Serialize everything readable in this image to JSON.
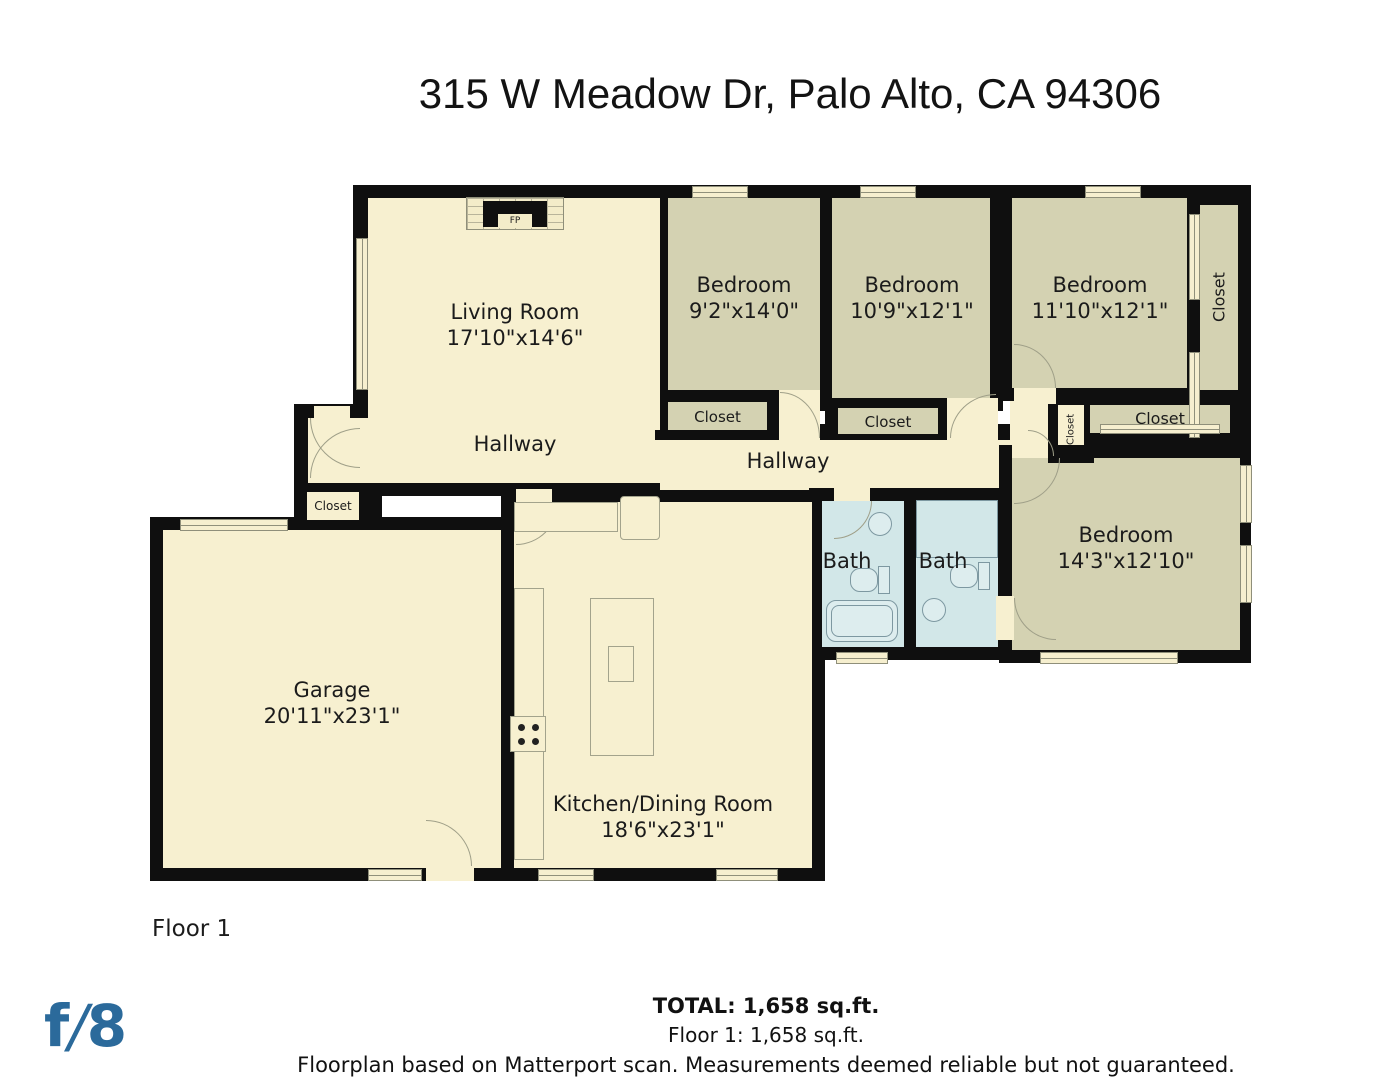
{
  "title": "315 W Meadow Dr, Palo Alto, CA 94306",
  "floor_label": "Floor 1",
  "rooms": {
    "living_room": {
      "name": "Living Room",
      "dims": "17'10\"x14'6\""
    },
    "bedroom_1": {
      "name": "Bedroom",
      "dims": "9'2\"x14'0\""
    },
    "bedroom_2": {
      "name": "Bedroom",
      "dims": "10'9\"x12'1\""
    },
    "bedroom_3": {
      "name": "Bedroom",
      "dims": "11'10\"x12'1\""
    },
    "bedroom_4": {
      "name": "Bedroom",
      "dims": "14'3\"x12'10\""
    },
    "garage": {
      "name": "Garage",
      "dims": "20'11\"x23'1\""
    },
    "kitchen_dining": {
      "name": "Kitchen/Dining Room",
      "dims": "18'6\"x23'1\""
    },
    "hallway_left": "Hallway",
    "hallway_center": "Hallway",
    "bath_left": "Bath",
    "bath_right": "Bath"
  },
  "closets": {
    "bedroom1_closet": "Closet",
    "bedroom2_closet": "Closet",
    "bedroom3_side_closet": "Closet",
    "hall_small_closet": "Closet",
    "bedroom4_closet": "Closet",
    "entry_closet": "Closet"
  },
  "fireplace_label": "FP",
  "footer": {
    "total": "TOTAL: 1,658 sq.ft.",
    "floor_total": "Floor 1: 1,658 sq.ft.",
    "disclaimer": "Floorplan based on Matterport scan. Measurements deemed reliable but not guaranteed."
  },
  "logo": {
    "f": "f",
    "slash": "/",
    "eight": "8"
  },
  "colors": {
    "floor_cream": "#f7f0d0",
    "room_olive": "#d4d2b2",
    "bath_blue": "#d2e7e8",
    "wall_black": "#0f0f0f",
    "logo_blue": "#2b6a9b"
  }
}
